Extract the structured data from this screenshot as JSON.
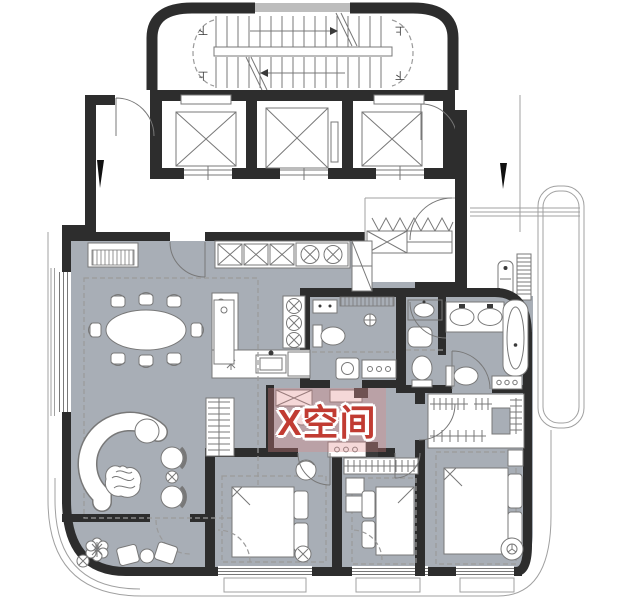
{
  "watermark": {
    "text": "X空间"
  },
  "stairs": {
    "top_left": "下",
    "top_right": "上",
    "bottom_left": "上",
    "bottom_right": "下"
  },
  "palette": {
    "wall": "#2d2d2d",
    "floor": "#a8aeb6",
    "line": "#787878",
    "line_light": "#a0a0a0",
    "dash": "#9a9a9a",
    "watermark_red": "#c13b32",
    "watermark_bg": "rgba(225,135,135,0.32)",
    "core_vent": "#bdbdbd",
    "accent_dark": "#3a3a3a"
  }
}
